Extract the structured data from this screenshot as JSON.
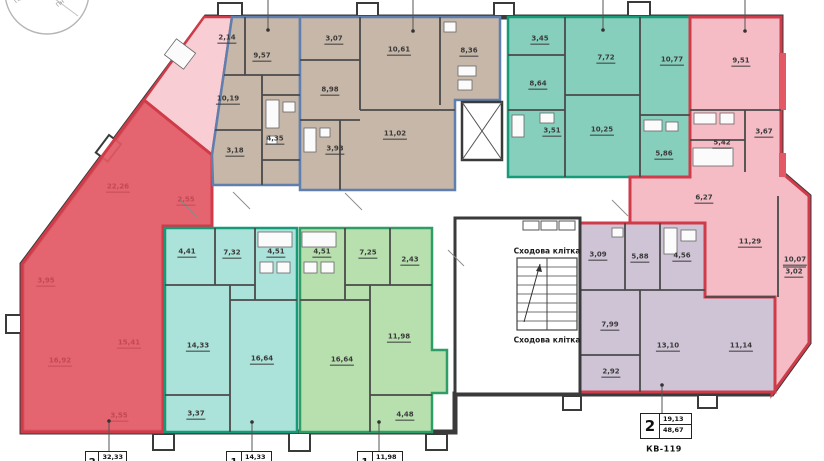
{
  "compass": {
    "label_a": "Пн",
    "label_b": "Пд"
  },
  "stairwell": {
    "top": "Сходова клітка",
    "bottom": "Сходова клітка"
  },
  "apartments": {
    "red": {
      "rooms": [
        "3,95",
        "22,26",
        "2,55",
        "15,41",
        "16,92",
        "3,55"
      ]
    },
    "tan1": {
      "rooms": [
        "2,14",
        "9,57",
        "10,19",
        "4,35",
        "3,18"
      ]
    },
    "tan2": {
      "rooms": [
        "3,07",
        "10,61",
        "8,36",
        "8,98",
        "11,02",
        "3,93"
      ]
    },
    "teal": {
      "rooms": [
        "3,45",
        "7,72",
        "10,77",
        "8,64",
        "3,51",
        "10,25",
        "5,86"
      ]
    },
    "pink": {
      "rooms": [
        "9,51",
        "3,67",
        "5,42",
        "6,27",
        "11,29",
        "10,07",
        "3,02"
      ]
    },
    "lilac": {
      "rooms": [
        "3,09",
        "5,88",
        "4,56",
        "7,99",
        "13,10",
        "2,92",
        "11,14"
      ]
    },
    "cyan": {
      "rooms": [
        "4,41",
        "7,32",
        "4,51",
        "14,33",
        "16,64",
        "3,37"
      ]
    },
    "green": {
      "rooms": [
        "4,51",
        "7,25",
        "2,43",
        "16,64",
        "11,98",
        "4,48"
      ]
    }
  },
  "stamps": {
    "left": {
      "number": "2",
      "value": "32,33"
    },
    "mid1": {
      "number": "1",
      "value": "14,33"
    },
    "mid2": {
      "number": "1",
      "value": "11,98"
    },
    "right": {
      "number": "2",
      "living": "19,13",
      "total": "48,67",
      "caption": "КВ-119"
    }
  },
  "colors": {
    "wall": "#3a3a3a",
    "red_fill": "#e25864",
    "red_line": "#cf3b49",
    "pink_fill": "#f5bcc6",
    "pink_light": "#f8cdd3",
    "tan_fill": "#c7b7a8",
    "tan_line": "#5f7fae",
    "teal_fill": "#86cfbc",
    "teal_line": "#169a77",
    "cyan_fill": "#abe2d9",
    "green_fill": "#b7e0ae",
    "green_line": "#2f9e66",
    "lilac_fill": "#cfc4d6"
  }
}
